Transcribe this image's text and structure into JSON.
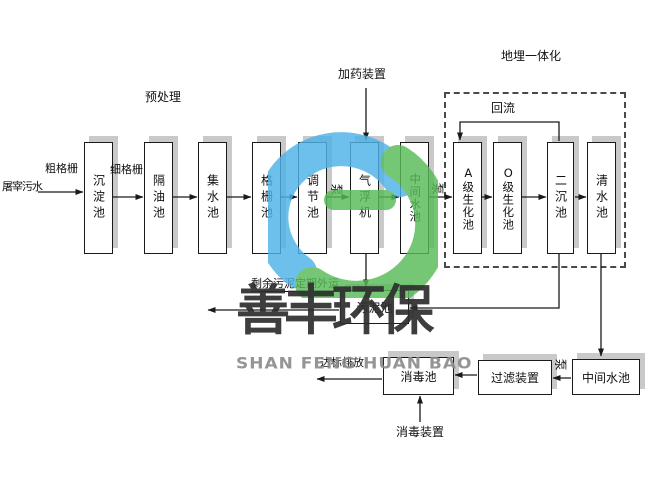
{
  "flow_labels": {
    "influent": "屠宰污水",
    "coarse_screen": "粗格栅",
    "fine_screen": "细格栅",
    "pretreatment": "预处理",
    "dosing_device": "加药装置",
    "buried_system": "地埋一体化",
    "reflux": "回流",
    "pump": "泵",
    "excess_sludge_out": "剩余污泥定期外运",
    "discharge_standard": "达标排放",
    "disinfection_device": "消毒装置"
  },
  "tanks": {
    "sedimentation": "沉淀池",
    "oil_separation": "隔油池",
    "water_collecting": "集水池",
    "screen_tank": "格栅池",
    "regulating": "调节池",
    "air_flotation": "气浮机",
    "intermediate_1": "中间水池",
    "a_biochemical": "A级生化池",
    "o_biochemical": "O级生化池",
    "secondary_sedimentation": "二沉池",
    "clear_water": "清水池",
    "sludge": "污泥池",
    "disinfection": "消毒池",
    "filter_device": "过滤装置",
    "intermediate_2": "中间水池"
  },
  "watermark": {
    "company_cn": "善丰环保",
    "company_en": "SHAN FENG HUAN BAO",
    "logo_blue": "#4fb3e8",
    "logo_green": "#57bb57"
  },
  "colors": {
    "box_border": "#1a1a1a",
    "box_shadow": "#c9c9c9",
    "line": "#1a1a1a",
    "dashed_border": "#4a4a4a",
    "watermark_cn": "#2e2e2e",
    "watermark_en": "#8a8a8a"
  }
}
